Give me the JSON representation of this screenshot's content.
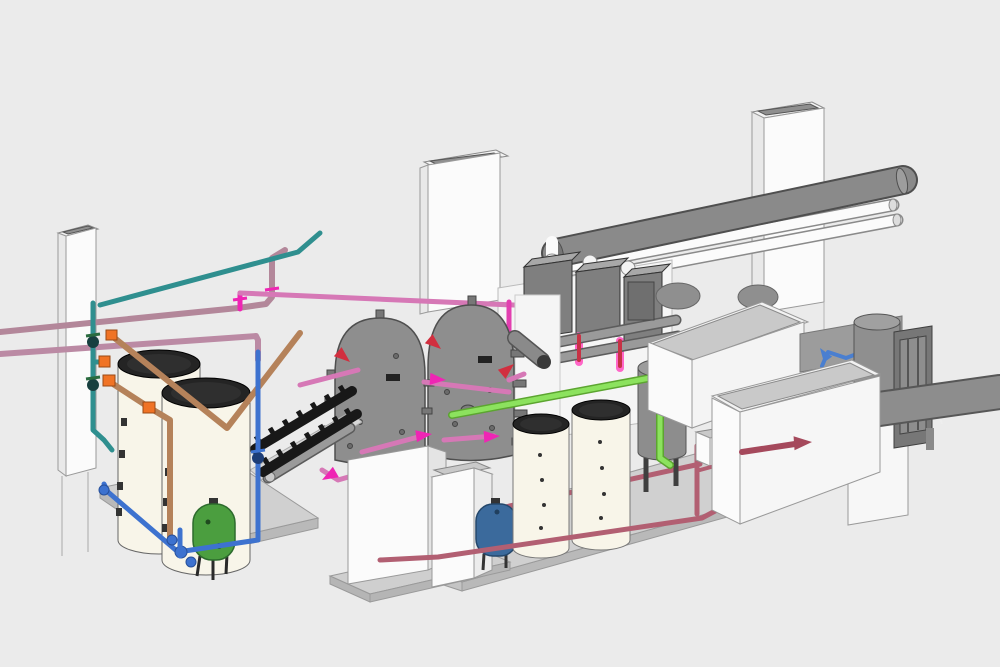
{
  "scene": {
    "description": "Isometric 3D CAD model of a commercial boiler plant room with storage tanks, boilers, flues and color-coded pipework",
    "background": "#ebebeb"
  },
  "colors": {
    "bg": "#ebebeb",
    "pipe_teal": "#2f8f8f",
    "pipe_teal_dark": "#1e6363",
    "pipe_copper": "#b5825a",
    "pipe_mauve": "#b3879a",
    "pipe_mauve2": "#bb8aa4",
    "pipe_pink": "#d678b6",
    "arrow_magenta": "#ef25b4",
    "arrow_red": "#d12f3f",
    "pipe_red": "#c73245",
    "pipe_dustyred": "#b25f72",
    "arrow_maroon": "#a5495c",
    "pipe_blue": "#3d72cf",
    "pipe_blue2": "#4a7fd0",
    "pipe_green": "#8ce25e",
    "pipe_green_dark": "#5ca530",
    "vessel_green": "#4b9e3f",
    "vessel_blue": "#3b6a9c",
    "tank_cream": "#f8f5e9",
    "tank_lid": "#242424",
    "equip_gray": "#8e8e8e",
    "equip_gray_dark": "#6f6f6f",
    "equip_white": "#f8f8f8",
    "lid_gray": "#c9c9c9",
    "base_gray": "#d0d0d0",
    "base_side": "#b9b9b9",
    "manifold_black": "#181818",
    "flue_gray": "#8a8a8a",
    "fitting_orange": "#f07325",
    "outline": "#5a5a5a"
  },
  "labels": {
    "scene_title": "Plant room 3D model",
    "left_flue": "Left flue riser column",
    "center_duct": "Central duct riser column",
    "right_duct": "Right duct riser column",
    "buffer_tanks": "Buffer storage tanks (cream, left)",
    "green_vessel": "Green expansion vessel",
    "blue_vessel": "Blue expansion vessel",
    "thermal_stores": "Thermal store tanks (dark gray)",
    "boilers": "Wall-hung gas boilers",
    "flue_header": "Main flue header duct",
    "air_pipes": "Combustion air intake pipes",
    "manifold": "Low-loss distribution manifold",
    "dhw_cylinders": "Hot water cylinders (cream, center)",
    "separator": "Air and dirt separator",
    "equip_box_rear": "Equipment unit (rear, white)",
    "equip_box_front": "Equipment unit (front, white)",
    "right_tank": "Storage tank (right)",
    "frame": "Equipment frame panel",
    "right_duct_pipe": "Exhaust duct (right)",
    "control_box": "Control box",
    "pipework": "Color-coded hydronic pipework"
  }
}
